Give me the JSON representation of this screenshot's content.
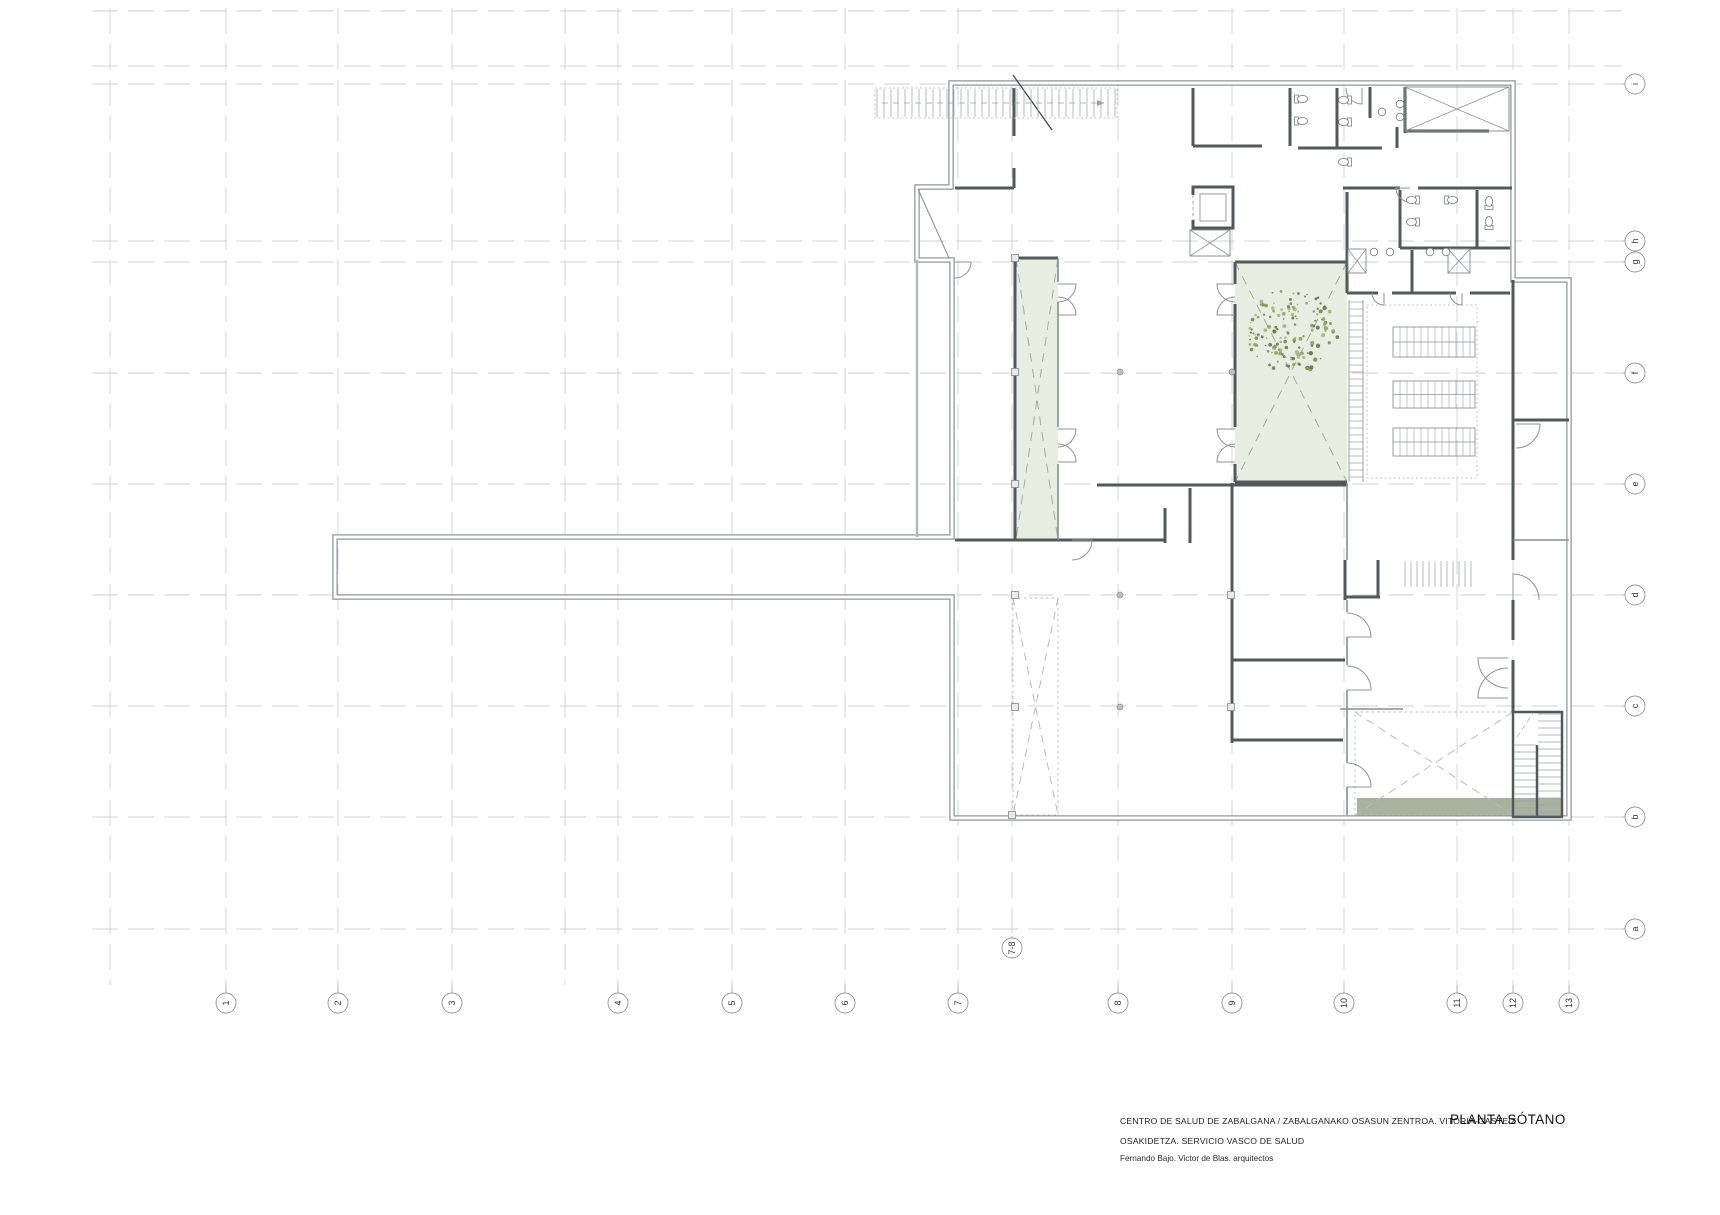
{
  "page": {
    "width": 1720,
    "height": 1215
  },
  "title_block": {
    "project_line": "CENTRO DE SALUD DE ZABALGANA / ZABALGANAKO OSASUN ZENTROA. VITORIA-GASTEIZ",
    "org_line": "OSAKIDETZA. SERVICIO VASCO DE SALUD",
    "architects_line": "Fernando Bajo. Victor de Blas.  arquitectos",
    "plan_title": "PLANTA SÓTANO"
  },
  "colors": {
    "grid": "#cdd1d3",
    "outer_wall": "#8f969a",
    "outer_core": "#ffffff",
    "dark_wall": "#53585b",
    "gray_wall": "#878d90",
    "light_wall": "#b4b9bb",
    "arc": "#8d9396",
    "tread": "#9aa0a3",
    "dotted": "#b0b5b8",
    "void_dash": "#b8bcbe",
    "patio_fill": "#e7eee1",
    "patio_cross": "#a3ad97",
    "green_strip": "#a9b29e",
    "bubble_stroke": "#8f969a",
    "bubble_text": "#333333",
    "fixture": "#777c7f",
    "tree_colors": [
      "#8a9a62",
      "#72834e",
      "#a2ae79",
      "#5d6e41"
    ]
  },
  "grid": {
    "col_span": [
      8,
      985
    ],
    "row_span": [
      92,
      1622
    ],
    "col_bubble_y": 1003,
    "row_bubble_x": 1635,
    "bubble_r": 10,
    "cols_bubbled": [
      {
        "label": "1",
        "x": 226
      },
      {
        "label": "2",
        "x": 338
      },
      {
        "label": "3",
        "x": 452
      },
      {
        "label": "4",
        "x": 618
      },
      {
        "label": "5",
        "x": 732
      },
      {
        "label": "6",
        "x": 845
      },
      {
        "label": "7",
        "x": 958
      },
      {
        "label": "8",
        "x": 1118
      },
      {
        "label": "9",
        "x": 1232
      },
      {
        "label": "10",
        "x": 1344
      },
      {
        "label": "11",
        "x": 1457
      },
      {
        "label": "12",
        "x": 1513
      },
      {
        "label": "13",
        "x": 1569
      }
    ],
    "cols_plain": [
      110,
      565
    ],
    "special_col": {
      "label": "7-8",
      "x": 1012,
      "line_top": 80,
      "line_end": 936,
      "bubble_y": 948
    },
    "rows_bubbled": [
      {
        "label": "i",
        "y": 84
      },
      {
        "label": "h",
        "y": 241
      },
      {
        "label": "g",
        "y": 262
      },
      {
        "label": "f",
        "y": 373
      },
      {
        "label": "e",
        "y": 484
      },
      {
        "label": "d",
        "y": 595
      },
      {
        "label": "c",
        "y": 706
      },
      {
        "label": "b",
        "y": 817
      },
      {
        "label": "a",
        "y": 929
      }
    ],
    "rows_plain": [
      11,
      66
    ]
  },
  "plan": {
    "outer_path": "M951 83 H1513 V280 H1569 V818 H952 V597 H335 V537 H952 V260 H917 V187 H951 Z",
    "retaining_wall": [
      917,
      260,
      917,
      537
    ],
    "dark_walls": [
      [
        1014,
        88,
        1014,
        136
      ],
      [
        1014,
        168,
        1014,
        188
      ],
      [
        955,
        188,
        1014,
        188
      ],
      [
        1193,
        88,
        1193,
        146
      ],
      [
        1193,
        146,
        1262,
        146
      ],
      [
        1290,
        88,
        1290,
        146
      ],
      [
        1337,
        88,
        1337,
        148
      ],
      [
        1298,
        148,
        1382,
        148
      ],
      [
        1370,
        87,
        1370,
        118
      ],
      [
        1397,
        127,
        1397,
        148
      ],
      [
        1405,
        87,
        1405,
        133
      ],
      [
        1405,
        131,
        1489,
        131
      ],
      [
        1343,
        188,
        1400,
        188
      ],
      [
        1418,
        188,
        1512,
        188
      ],
      [
        1400,
        190,
        1400,
        248
      ],
      [
        1477,
        190,
        1477,
        248
      ],
      [
        1400,
        248,
        1510,
        248
      ],
      [
        1347,
        192,
        1347,
        293
      ],
      [
        1412,
        250,
        1412,
        293
      ],
      [
        1347,
        293,
        1378,
        293
      ],
      [
        1392,
        293,
        1456,
        293
      ],
      [
        1470,
        293,
        1510,
        293
      ],
      [
        1015,
        258,
        1058,
        258
      ],
      [
        1015,
        258,
        1015,
        540
      ],
      [
        1097,
        485,
        1347,
        485
      ],
      [
        1165,
        508,
        1165,
        543
      ],
      [
        1190,
        488,
        1190,
        543
      ],
      [
        955,
        540,
        1165,
        540
      ],
      [
        1235,
        262,
        1347,
        262
      ],
      [
        1235,
        482,
        1347,
        482
      ],
      [
        1235,
        262,
        1235,
        284
      ],
      [
        1235,
        304,
        1235,
        427
      ],
      [
        1235,
        464,
        1235,
        482
      ],
      [
        1232,
        483,
        1232,
        743
      ],
      [
        1232,
        660,
        1345,
        660
      ],
      [
        1232,
        740,
        1343,
        740
      ],
      [
        1345,
        560,
        1345,
        600
      ],
      [
        1345,
        597,
        1380,
        597
      ],
      [
        1378,
        560,
        1378,
        597
      ],
      [
        1513,
        280,
        1513,
        560
      ],
      [
        1513,
        600,
        1513,
        640
      ],
      [
        1513,
        660,
        1513,
        712
      ],
      [
        1513,
        420,
        1569,
        420
      ]
    ],
    "gray_walls": [
      [
        1058,
        258,
        1058,
        282
      ],
      [
        1058,
        302,
        1058,
        427
      ],
      [
        1058,
        464,
        1058,
        540
      ],
      [
        1347,
        483,
        1347,
        560
      ],
      [
        1347,
        600,
        1347,
        612
      ],
      [
        1347,
        637,
        1347,
        665
      ],
      [
        1347,
        690,
        1347,
        763
      ],
      [
        1347,
        787,
        1347,
        815
      ],
      [
        1340,
        709,
        1403,
        709
      ],
      [
        1513,
        540,
        1569,
        540
      ]
    ],
    "patios": [
      {
        "x": 1016,
        "y": 258,
        "w": 42,
        "h": 282
      },
      {
        "x": 1235,
        "y": 262,
        "w": 112,
        "h": 220
      }
    ],
    "voids": [
      {
        "x": 1013,
        "y": 598,
        "w": 45,
        "h": 217
      },
      {
        "x": 1355,
        "y": 712,
        "w": 158,
        "h": 103
      }
    ],
    "green_strip": {
      "x": 1357,
      "y": 798,
      "w": 205,
      "h": 19
    },
    "xboxes": [
      {
        "x": 1405,
        "y": 87,
        "w": 104,
        "h": 44
      },
      {
        "x": 1348,
        "y": 249,
        "w": 18,
        "h": 24
      },
      {
        "x": 1448,
        "y": 249,
        "w": 22,
        "h": 24
      },
      {
        "x": 1190,
        "y": 230,
        "w": 40,
        "h": 26
      }
    ],
    "annex_diag": [
      918,
      189,
      949,
      258
    ],
    "section_line": [
      1013,
      75,
      1052,
      130
    ],
    "flow_arrow": [
      882,
      103,
      1104,
      103
    ],
    "stairs": {
      "top": {
        "x": 875,
        "y": 88,
        "w": 242,
        "h": 30,
        "step": 7,
        "dotted": true
      },
      "mid": {
        "x": 1403,
        "y": 560,
        "w": 70,
        "h": 28,
        "step": 6,
        "dotted": false
      },
      "ladder": {
        "x": 1349,
        "y": 300,
        "w": 14,
        "h": 182,
        "step": 7
      },
      "br": {
        "x": 1513,
        "y": 712,
        "w": 49,
        "h": 105,
        "divider_x": 1537,
        "divider_y1": 745,
        "flight_left": {
          "x1": 1514,
          "x2": 1536,
          "y1": 745,
          "y2": 815,
          "step": 7
        },
        "flight_right": {
          "x1": 1538,
          "x2": 1561,
          "y1": 714,
          "y2": 815,
          "step": 7
        },
        "dash_diag": [
          1517,
          737,
          1533,
          713
        ]
      }
    },
    "shelves": [
      {
        "x": 1393,
        "y": 327,
        "w": 82,
        "h": 30
      },
      {
        "x": 1393,
        "y": 381,
        "w": 82,
        "h": 27
      },
      {
        "x": 1393,
        "y": 428,
        "w": 82,
        "h": 28
      }
    ],
    "archive": {
      "x": 1367,
      "y": 305,
      "w": 110,
      "h": 173
    },
    "elevator": {
      "x": 1193,
      "y": 187,
      "w": 40,
      "h": 41
    },
    "arcs": [
      [
        1058,
        284,
        18,
        0,
        90
      ],
      [
        1058,
        315,
        18,
        0,
        -90
      ],
      [
        1058,
        429,
        18,
        0,
        90
      ],
      [
        1058,
        462,
        18,
        0,
        -90
      ],
      [
        1235,
        284,
        18,
        180,
        90
      ],
      [
        1235,
        315,
        18,
        180,
        270
      ],
      [
        1235,
        429,
        18,
        180,
        90
      ],
      [
        1235,
        462,
        18,
        180,
        270
      ],
      [
        955,
        262,
        16,
        0,
        90
      ],
      [
        1072,
        540,
        20,
        0,
        90
      ],
      [
        1347,
        637,
        24,
        0,
        -90
      ],
      [
        1347,
        690,
        24,
        0,
        -90
      ],
      [
        1347,
        787,
        24,
        0,
        -90
      ],
      [
        1508,
        658,
        30,
        180,
        90
      ],
      [
        1508,
        698,
        30,
        180,
        270
      ],
      [
        1516,
        424,
        24,
        0,
        90
      ],
      [
        1513,
        600,
        26,
        -90,
        0
      ],
      [
        1362,
        88,
        16,
        90,
        180
      ],
      [
        1384,
        293,
        12,
        90,
        180
      ],
      [
        1462,
        293,
        12,
        90,
        180
      ],
      [
        1410,
        188,
        14,
        180,
        90
      ]
    ],
    "wc": [
      [
        1302,
        99,
        -90
      ],
      [
        1302,
        121,
        -90
      ],
      [
        1344,
        100,
        90
      ],
      [
        1344,
        122,
        90
      ],
      [
        1344,
        162,
        90
      ],
      [
        1412,
        200,
        90
      ],
      [
        1412,
        222,
        90
      ],
      [
        1452,
        200,
        -90
      ],
      [
        1489,
        202,
        180
      ],
      [
        1489,
        222,
        180
      ]
    ],
    "sinks": [
      [
        1374,
        252
      ],
      [
        1390,
        252
      ],
      [
        1430,
        252
      ],
      [
        1446,
        252
      ],
      [
        1400,
        104
      ],
      [
        1400,
        117
      ],
      [
        1382,
        112
      ]
    ],
    "squares": [
      [
        1015,
        258
      ],
      [
        1015,
        372
      ],
      [
        1015,
        484
      ],
      [
        1015,
        595
      ],
      [
        1015,
        707
      ],
      [
        1012,
        815
      ],
      [
        1231,
        595
      ],
      [
        1231,
        707
      ]
    ],
    "dots": [
      [
        1120,
        372
      ],
      [
        1120,
        595
      ],
      [
        1120,
        707
      ],
      [
        1232,
        372
      ]
    ],
    "tree": {
      "cx": 1292,
      "cy": 331,
      "r": 46,
      "n": 150
    }
  }
}
